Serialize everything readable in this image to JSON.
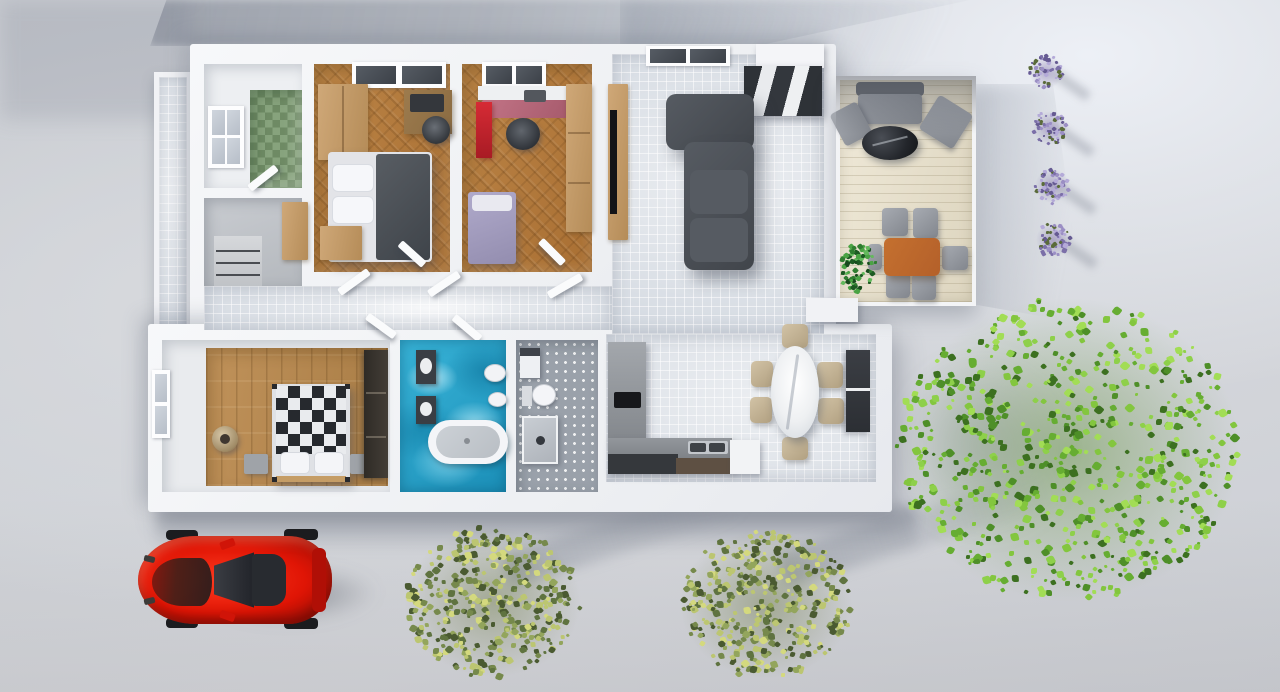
{
  "scene": {
    "type": "3d-floorplan-render",
    "view": "top-down aerial",
    "labels": {
      "house": "Single-story house floor plan",
      "living_room": "Living room",
      "kitchen": "Kitchen",
      "dining_area": "Dining area",
      "bedroom_master": "Master bedroom",
      "bedroom_kids": "Kids bedroom / office",
      "bedroom_guest": "Guest bedroom",
      "bathroom_main": "Main bathroom with tub",
      "bathroom_second": "Second bathroom with shower",
      "utility_room": "Utility room",
      "entry_hall": "Entry hall",
      "hallway": "Hallway",
      "patio": "Patio deck",
      "terrace_strip": "Side walkway",
      "car": "Red sports car",
      "tree_large": "Large green tree",
      "bush_left": "Green bush",
      "bush_right": "Green bush",
      "lavender": "Lavender plant"
    },
    "furniture": {
      "sofa": "L-shaped sofa",
      "tv_wall": "TV wall unit",
      "tall_cabinet": "Living room cabinet",
      "credenza": "White credenza",
      "dining_table": "Oval marble dining table",
      "dining_chair": "Dining chair",
      "kitchen_counter": "Kitchen counter",
      "kitchen_column": "Kitchen tall unit",
      "cooktop": "Cooktop",
      "kitchen_sink": "Kitchen sink",
      "dishwasher": "Dishwasher",
      "bed_master": "Double bed",
      "wardrobe": "Wardrobe",
      "dresser": "Dresser",
      "desk": "Desk",
      "desk_chair": "Desk chair",
      "bed_single": "Single bed",
      "bed_checkered": "Bed with checkered duvet",
      "nightstand": "Nightstand",
      "basket": "Round basket",
      "vanity": "Bathroom vanity",
      "bathtub": "Freestanding bathtub",
      "toilet": "Toilet",
      "bidet": "Bidet",
      "washbasin": "Washbasin",
      "shower": "Shower",
      "front_door": "Front door steps",
      "closet": "Entry closet",
      "outdoor_sofa": "Outdoor sofa",
      "outdoor_armchair": "Outdoor armchair",
      "fire_table": "Round stone coffee table",
      "patio_table": "Patio dining table",
      "patio_chair": "Patio chair",
      "potted_plant": "Potted plant",
      "window": "Window"
    },
    "colors": {
      "ground": "#cfd2d7",
      "wall": "#f3f4f7",
      "tile_floor": "#d2d8e0",
      "wood_floor": "#b07a3e",
      "plank_floor": "#b68a52",
      "green_tile": "#7a9671",
      "water_mosaic": "#2aa6cc",
      "sofa": "#565b62",
      "car_red": "#e01505",
      "deck": "#e9e3d1",
      "tree_green": "#66ad32",
      "bush_olive": "#76894c",
      "lavender_purple": "#8d81b5",
      "patio_table": "#b4602a",
      "kitchen_gray": "#85898e",
      "marble": "#f2f3f5"
    }
  }
}
